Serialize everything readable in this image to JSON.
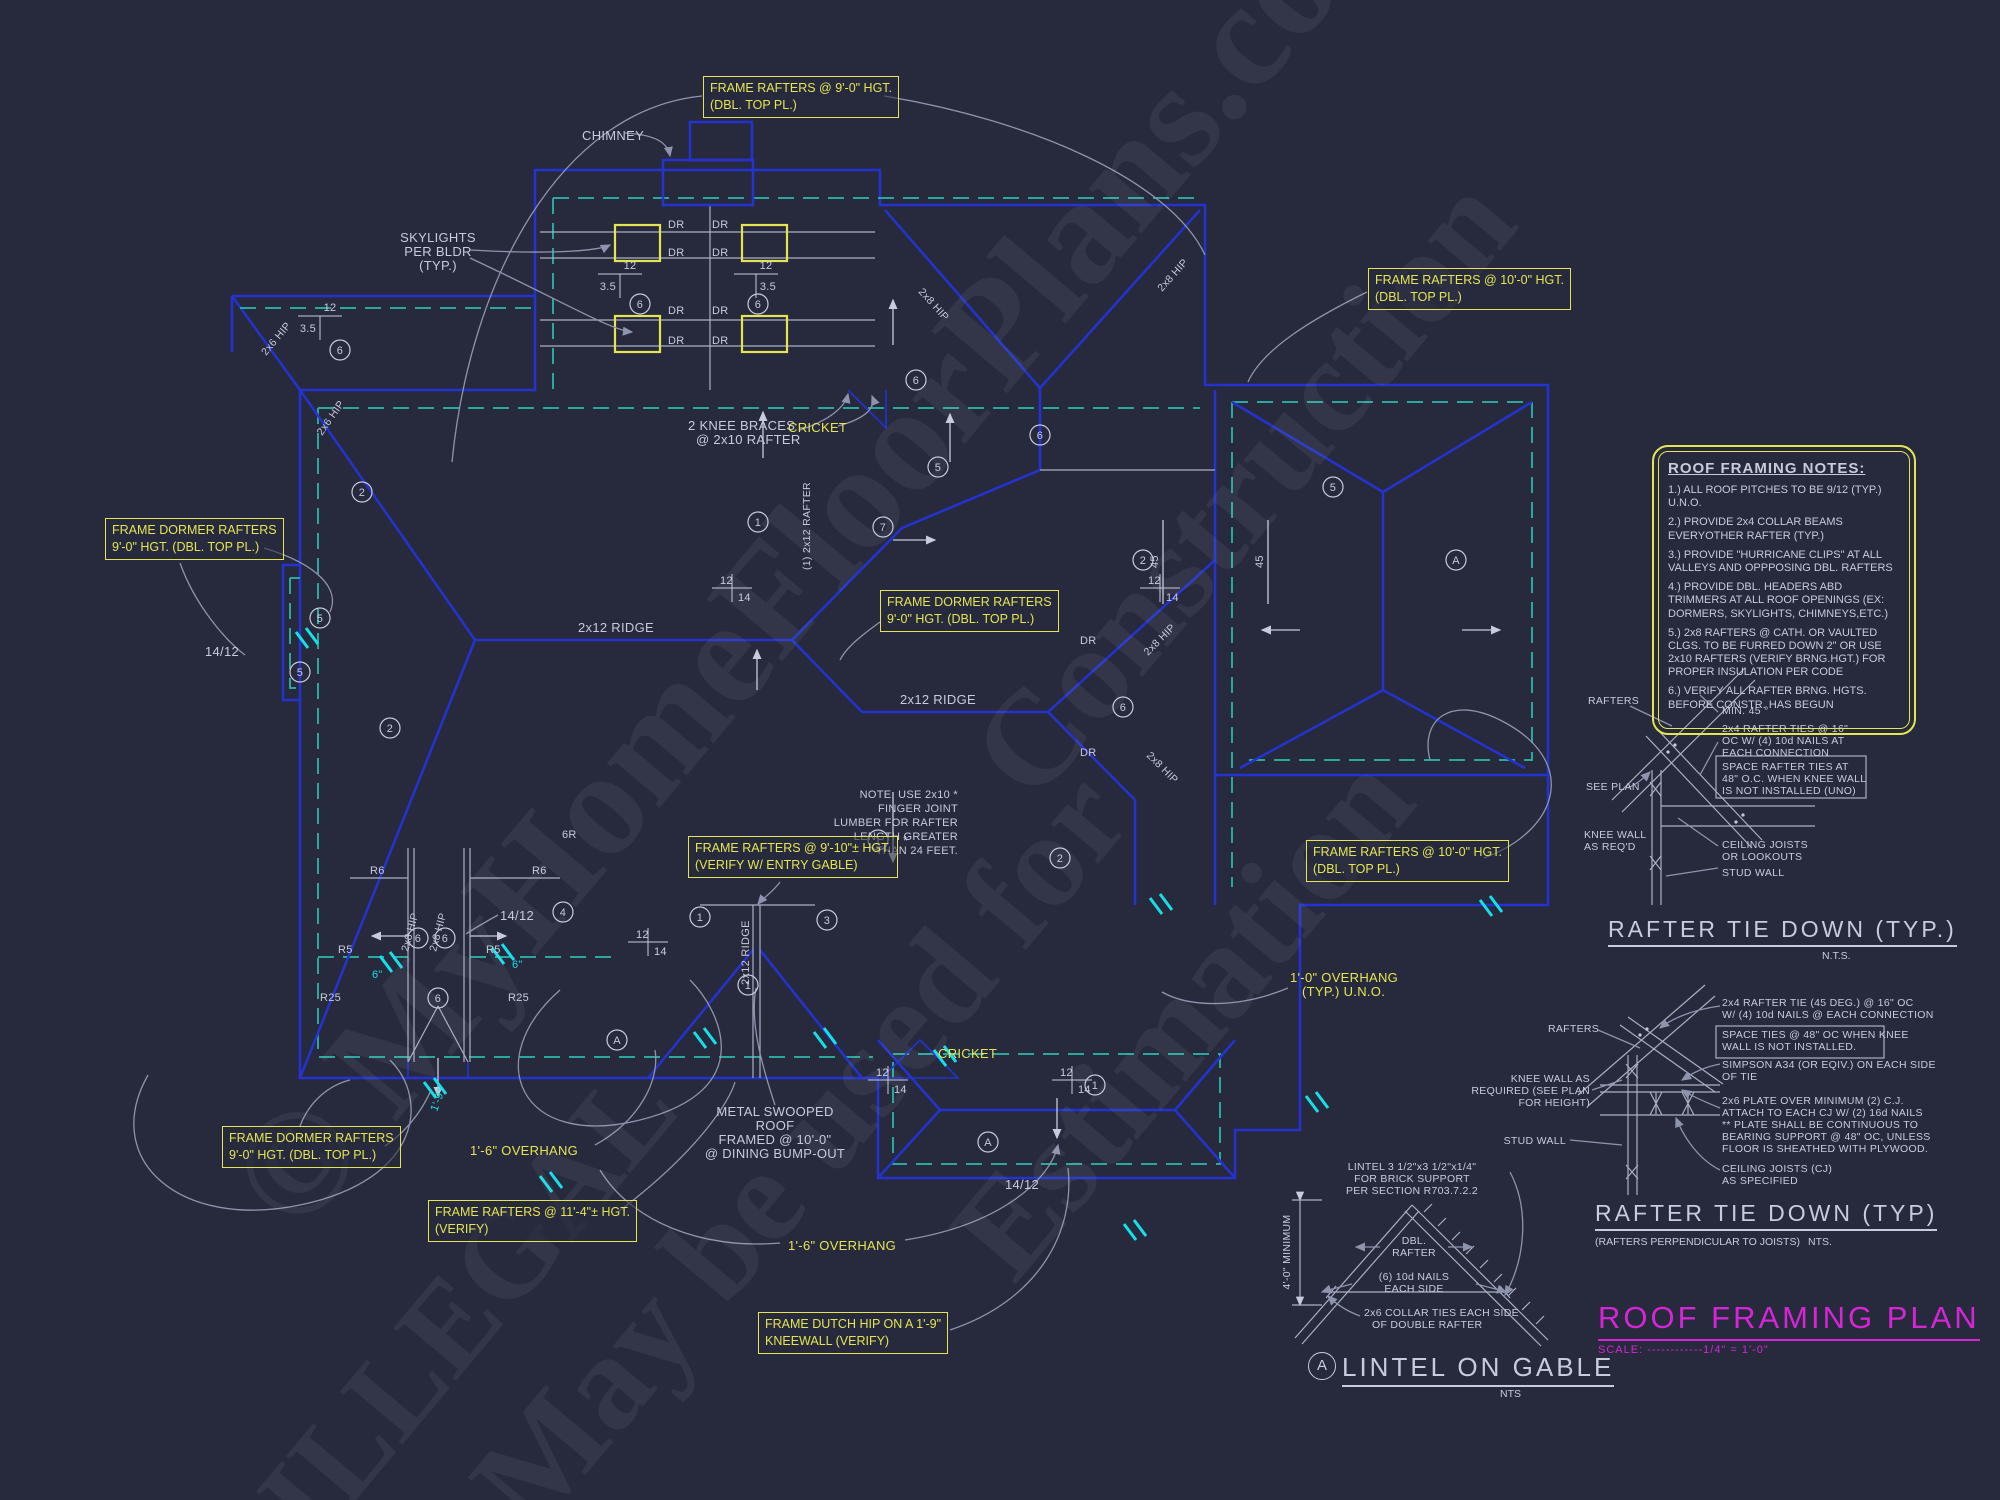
{
  "watermarks": [
    "© MyHomeFloorPlans.com",
    "May be used for",
    "Construction",
    "Estimation",
    "ILLEGAL"
  ],
  "title_block": {
    "title": "ROOF FRAMING PLAN",
    "scale": "SCALE: ------------1/4\" = 1'-0\""
  },
  "notes_box": {
    "title": "ROOF FRAMING NOTES:",
    "notes": [
      "1.) ALL ROOF PITCHES TO BE  9/12 (TYP.) U.N.O.",
      "2.) PROVIDE 2x4 COLLAR BEAMS EVERYOTHER RAFTER (TYP.)",
      "3.) PROVIDE \"HURRICANE CLIPS\" AT ALL VALLEYS AND OPPPOSING DBL. RAFTERS",
      "4.) PROVIDE DBL. HEADERS ABD TRIMMERS AT ALL ROOF OPENINGS (EX: DORMERS, SKYLIGHTS, CHIMNEYS,ETC.)",
      "5.) 2x8 RAFTERS @ CATH. OR VAULTED CLGS. TO BE FURRED DOWN 2\" OR USE 2x10 RAFTERS (VERIFY BRNG.HGT.) FOR PROPER INSULATION PER CODE",
      "6.) VERIFY ALL RAFTER BRNG. HGTS. BEFORE CONSTR. HAS BEGUN"
    ]
  },
  "callouts": {
    "c1": [
      "FRAME RAFTERS @ 9'-0\" HGT.",
      "(DBL. TOP PL.)"
    ],
    "c2": [
      "FRAME RAFTERS @ 10'-0\" HGT.",
      "(DBL. TOP PL.)"
    ],
    "c3": [
      "FRAME DORMER RAFTERS",
      "9'-0\" HGT. (DBL. TOP PL.)"
    ],
    "c4": [
      "FRAME DORMER RAFTERS",
      "9'-0\" HGT. (DBL. TOP PL.)"
    ],
    "c5": [
      "FRAME RAFTERS @ 9'-10\"± HGT.",
      "(VERIFY W/ ENTRY GABLE)"
    ],
    "c6": [
      "FRAME RAFTERS @ 10'-0\" HGT.",
      "(DBL. TOP PL.)"
    ],
    "c7": [
      "FRAME DORMER RAFTERS",
      "9'-0\" HGT. (DBL. TOP PL.)"
    ],
    "c8": [
      "FRAME RAFTERS @ 11'-4\"± HGT.",
      "(VERIFY)"
    ],
    "c9": [
      "FRAME DUTCH HIP ON A 1'-9\"",
      "KNEEWALL (VERIFY)"
    ]
  },
  "plan": {
    "chimney": "CHIMNEY",
    "skylights": [
      "SKYLIGHTS",
      "PER BLDR",
      "(TYP.)"
    ],
    "knee_braces": [
      "2 KNEE BRACES",
      "@ 2x10 RAFTER"
    ],
    "cricket": "CRICKET",
    "ridge_2x12": "2x12 RIDGE",
    "note": [
      "NOTE: USE 2x10 *",
      "FINGER JOINT",
      "LUMBER FOR RAFTER",
      "LENGTH GREATER",
      "THAN 24 FEET."
    ],
    "metal_roof": [
      "METAL SWOOPED",
      "ROOF",
      "FRAMED @ 10'-0\"",
      "@ DINING BUMP-OUT"
    ],
    "overhang_16": "1'-6\" OVERHANG",
    "overhang_10": [
      "1'-0\" OVERHANG",
      "(TYP.) U.N.O."
    ],
    "pitch_14_12": "14/12",
    "dr": "DR",
    "r5": "R5",
    "r6": "R6",
    "r25": "R25",
    "r6_rev": "6R",
    "hip_2x8": "2x8 HIP",
    "hip_2x6": "2x6 HIP",
    "rafter_2x12": "(1) 2x12 RAFTER",
    "dim_45": "45",
    "p12": "12",
    "p35": "3.5",
    "p14": "14",
    "dim_6in": "6\"",
    "dim_1_9": "1'-9\"",
    "asterisk": "*"
  },
  "bubbles": {
    "b1": "1",
    "b2": "2",
    "b3": "3",
    "b4": "4",
    "b5": "5",
    "b6": "6",
    "b7": "7",
    "ba": "A"
  },
  "detail1": {
    "rafters": "RAFTERS",
    "min45": "MIN. 45 °",
    "tie": [
      "2x4 RAFTER TIES @ 16\"",
      "OC W/ (4) 10d NAILS AT",
      "EACH CONNECTION"
    ],
    "space": [
      "SPACE RAFTER TIES AT",
      "48\" O.C. WHEN KNEE WALL",
      "IS NOT INSTALLED (UNO)"
    ],
    "see_plan": "SEE PLAN",
    "knee": [
      "KNEE WALL",
      "AS REQ'D"
    ],
    "joists": [
      "CEILING JOISTS",
      "OR LOOKOUTS"
    ],
    "stud": "STUD WALL",
    "title": "RAFTER TIE DOWN (TYP.)",
    "nts": "N.T.S."
  },
  "detail2": {
    "rafters": "RAFTERS",
    "tie": [
      "2x4 RAFTER TIE (45 DEG.) @ 16\" OC",
      "W/ (4) 10d NAILS @ EACH CONNECTION"
    ],
    "space": [
      "SPACE TIES @ 48\" OC WHEN KNEE",
      "WALL IS NOT INSTALLED."
    ],
    "simpson": [
      "SIMPSON A34 (OR EQIV.) ON EACH SIDE",
      "OF TIE"
    ],
    "knee": [
      "KNEE WALL AS",
      "REQUIRED (SEE PLAN",
      "FOR HEIGHT)"
    ],
    "plate": [
      "2x6 PLATE OVER MINIMUM (2) C.J.",
      "ATTACH TO EACH CJ W/ (2) 16d NAILS",
      "** PLATE SHALL BE CONTINUOUS TO",
      "BEARING SUPPORT @ 48\" OC, UNLESS",
      "FLOOR IS SHEATHED WITH PLYWOOD."
    ],
    "joists": [
      "CEILING JOISTS (CJ)",
      "AS SPECIFIED"
    ],
    "stud": "STUD WALL",
    "title": "RAFTER TIE DOWN (TYP)",
    "subtitle": "(RAFTERS PERPENDICULAR TO JOISTS)",
    "nts": "NTS."
  },
  "detail3": {
    "bubble": "A",
    "lintel": [
      "LINTEL 3 1/2\"x3 1/2\"x1/4\"",
      "FOR BRICK SUPPORT",
      "PER SECTION R703.7.2.2"
    ],
    "min": "4'-0\" MINIMUM",
    "dbl": [
      "DBL.",
      "RAFTER"
    ],
    "nails": [
      "(6) 10d NAILS",
      "EACH SIDE"
    ],
    "collar": [
      "2x6 COLLAR TIES EACH SIDE",
      "OF DOUBLE RAFTER"
    ],
    "title": "LINTEL ON GABLE",
    "nts": "NTS"
  }
}
